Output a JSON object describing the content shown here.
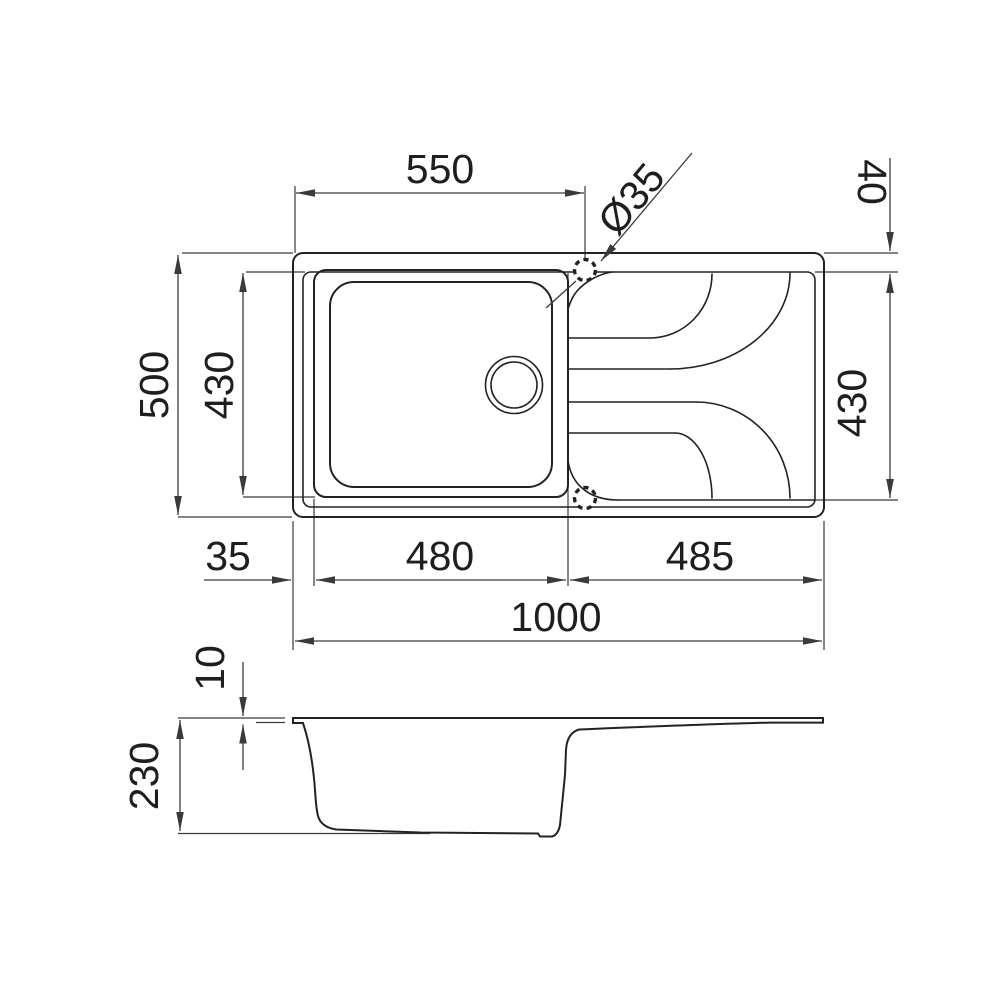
{
  "title": "Sink technical drawing",
  "colors": {
    "line": "#222222",
    "dim": "#3a3a3a",
    "bg": "#ffffff",
    "text": "#1e1e1e"
  },
  "plan_view": {
    "dims": {
      "top_width": "550",
      "tap_hole_diameter": "Ø35",
      "ledge_depth": "40",
      "overall_depth": "500",
      "bowl_depth": "430",
      "drainer_depth": "430",
      "left_offset": "35",
      "bowl_width": "480",
      "drainer_width": "485",
      "overall_width": "1000"
    }
  },
  "side_view": {
    "dims": {
      "rim_thickness": "10",
      "overall_height": "230"
    }
  }
}
